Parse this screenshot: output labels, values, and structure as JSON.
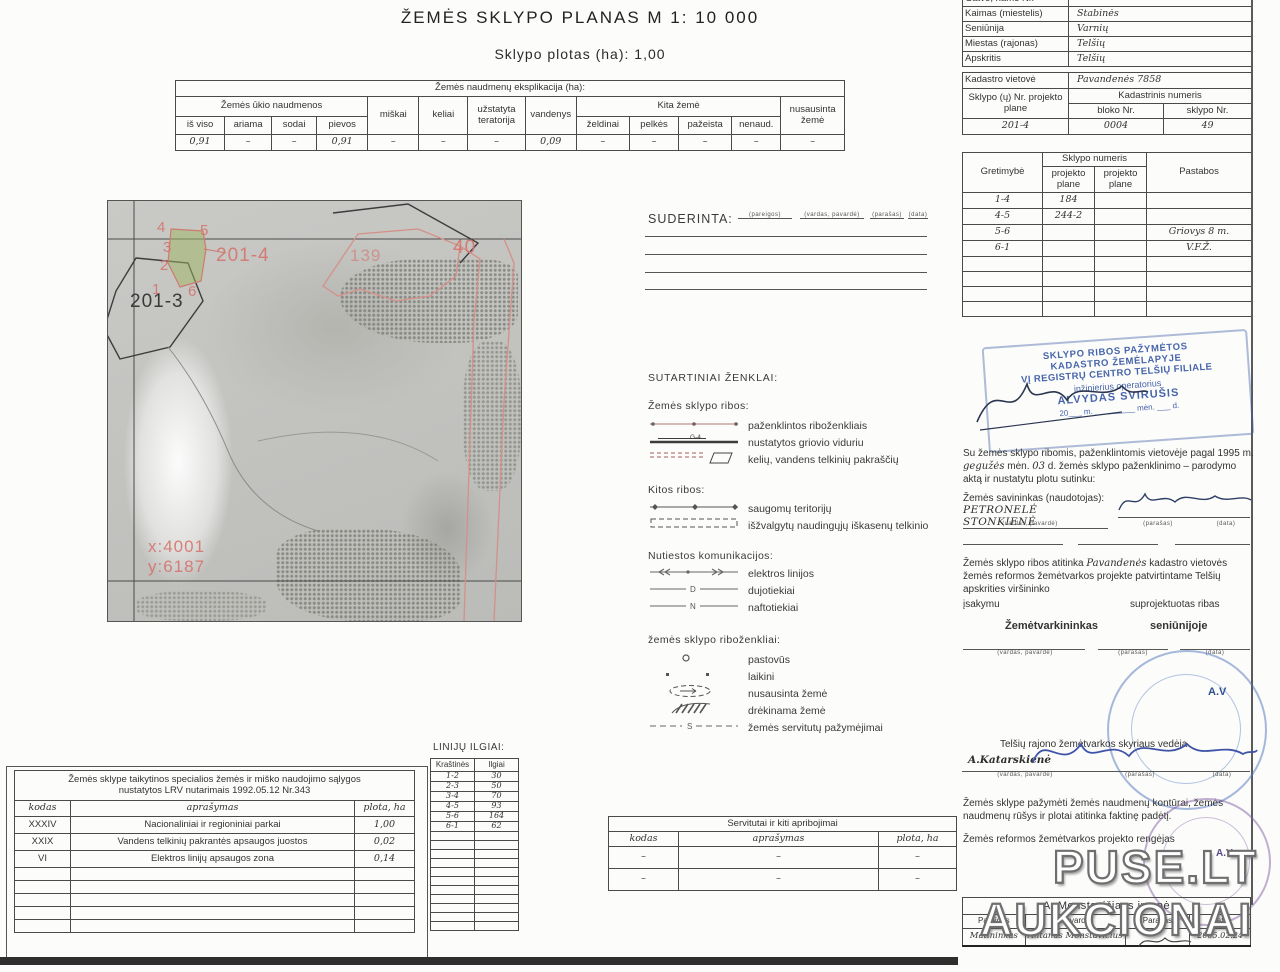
{
  "page": {
    "title": "ŽEMĖS SKLYPO PLANAS M 1: 10 000",
    "subtitle": "Sklypo plotas (ha): 1,00"
  },
  "explication": {
    "title": "Žemės naudmenų eksplikacija (ha):",
    "group_agri": "Žemės ūkio naudmenos",
    "group_kita": "Kita žemė",
    "col_miskai": "miškai",
    "col_keliai": "keliai",
    "col_uzstatyta": "užstatyta teratorija",
    "col_vandenys": "vandenys",
    "col_nusausinta": "nusausinta žemė",
    "sub": [
      "iš viso",
      "ariama",
      "sodai",
      "pievos",
      "želdinai",
      "pelkės",
      "pažeista",
      "nenaud."
    ],
    "values": [
      "0,91",
      "–",
      "–",
      "0,91",
      "–",
      "–",
      "–",
      "0,09",
      "–",
      "–",
      "–",
      "–",
      "–"
    ]
  },
  "location": {
    "rows": [
      {
        "label": "Gatvė, namo Nr.",
        "value": ""
      },
      {
        "label": "Kaimas (miestelis)",
        "value": "Stabinės"
      },
      {
        "label": "Seniūnija",
        "value": "Varnių"
      },
      {
        "label": "Miestas (rajonas)",
        "value": "Telšių"
      },
      {
        "label": "Apskritis",
        "value": "Telšių"
      }
    ]
  },
  "cadastre": {
    "vietove_label": "Kadastro vietovė",
    "vietove_value": "Pavandenės 7858",
    "sklypo_nr_label": "Sklypo (ų) Nr. projekto plane",
    "kadastrinis_label": "Kadastrinis numeris",
    "bloko_label": "bloko Nr.",
    "sklypo_label": "sklypo Nr.",
    "projekto_value": "201-4",
    "bloko_value": "0004",
    "sklypo_value": "49"
  },
  "gretimybe": {
    "h_gretimybe": "Gretimybė",
    "h_sklypo": "Sklypo numeris",
    "h_proj1": "projekto plane",
    "h_proj2": "projekto plane",
    "h_pastabos": "Pastabos",
    "rows": [
      [
        "1-4",
        "184",
        "",
        ""
      ],
      [
        "4-5",
        "244-2",
        "",
        ""
      ],
      [
        "5-6",
        "",
        "",
        "Griovys 8 m."
      ],
      [
        "6-1",
        "",
        "",
        "V.F.Ž."
      ]
    ]
  },
  "stamp": {
    "l1": "SKLYPO RIBOS PAŽYMĖTOS",
    "l2": "KADASTRO ŽEMĖLAPYJE",
    "l3": "VĮ REGISTRŲ CENTRO TELŠIŲ FILIALE",
    "l4": "inžinierius operatorius",
    "l5": "ALVYDAS SVIRUŠIS",
    "date": "20___ m. _________ mėn. ___ d."
  },
  "consent": {
    "p1": "Su žemės sklypo ribomis, paženklintomis vietovėje pagal 1995 m.",
    "month": "gegužės",
    "p2": "mėn.",
    "day": "03",
    "p3": "d. žemės sklypo paženklinimo – parodymo aktą ir nustatytu plotu sutinku:",
    "owner_label": "Žemės savininkas (naudotojas):",
    "owner_name": "PETRONELĖ STONKIENĖ",
    "cap_name": "(vardas, pavardė)",
    "cap_sign": "(parašas)",
    "cap_date": "(data)"
  },
  "match": {
    "a": "Žemės sklypo ribos atitinka",
    "b": "Pavandenės",
    "c": "kadastro vietovės žemės reformos žemėtvarkos projekte patvirtintame Telšių apskrities viršininko",
    "d": "įsakymu",
    "e": "suprojektuotas ribas",
    "role1": "Žemėtvarkininkas",
    "role2": "seniūnijoje"
  },
  "vedeja": {
    "line": "Telšių rajono žemėtvarkos skyriaus vedėja",
    "name": "A.Katarskienė",
    "av": "A.V"
  },
  "note": {
    "text": "Žemės sklype pažymėti žemės naudmenų kontūrai, žemės naudmenų rūšys ir plotai atitinka faktinę padėtį.",
    "text2": "Žemės reformos žemėtvarkos projekto rengėjas"
  },
  "firm": {
    "title": "A. Monstavičiaus įmonė",
    "h": [
      "Pareigos",
      "Pavardė",
      "Parašas",
      "data"
    ],
    "row": [
      "Matininkas",
      "Antanas Monstavičius",
      "",
      "2005.02.24"
    ]
  },
  "watermark": {
    "line1": "PUSE.LT",
    "line2": "AUKCIONAI"
  },
  "suderinta": {
    "label": "SUDERINTA:",
    "caps": [
      "(pareigos)",
      "(vardas, pavardė)",
      "(parašas)",
      "(data)"
    ]
  },
  "legend": {
    "title": "SUTARTINIAI ŽENKLAI:",
    "s1_title": "Žemės sklypo ribos:",
    "s1_items": [
      "paženklintos riboženkliais",
      "nustatytos griovio viduriu",
      "kelių, vandens telkinių pakraščių"
    ],
    "g4": "G-4",
    "s2_title": "Kitos ribos:",
    "s2_items": [
      "saugomų teritorijų",
      "išžvalgytų naudingųjų iškasenų telkinio"
    ],
    "s3_title": "Nutiestos komunikacijos:",
    "s3_items": [
      "elektros linijos",
      "dujotiekiai",
      "naftotiekiai"
    ],
    "sym_d": "D",
    "sym_n": "N",
    "sym_s": "S",
    "s4_title": "žemės sklypo riboženkliai:",
    "s4_items": [
      "pastovūs",
      "laikini",
      "nusausinta žemė",
      "drėkinama žemė",
      "žemės servitutų pažymėjimai"
    ]
  },
  "lengths": {
    "title": "LINIJŲ ILGIAI:",
    "h1": "Kraštinės",
    "h2": "Ilgiai",
    "rows": [
      [
        "1-2",
        "30"
      ],
      [
        "2-3",
        "50"
      ],
      [
        "3-4",
        "70"
      ],
      [
        "4-5",
        "93"
      ],
      [
        "5-6",
        "164"
      ],
      [
        "6-1",
        "62"
      ]
    ]
  },
  "special": {
    "title1": "Žemės sklype taikytinos specialios žemės ir miško naudojimo sąlygos",
    "title2": "nustatytos LRV nutarimais 1992.05.12  Nr.343",
    "h": [
      "kodas",
      "aprašymas",
      "plota, ha"
    ],
    "rows": [
      [
        "XXXIV",
        "Nacionaliniai ir regioniniai parkai",
        "1,00"
      ],
      [
        "XXIX",
        "Vandens telkinių pakrantės apsaugos juostos",
        "0,02"
      ],
      [
        "VI",
        "Elektros linijų apsaugos zona",
        "0,14"
      ]
    ]
  },
  "servitutai": {
    "title": "Servitutai ir kiti apribojimai",
    "h": [
      "kodas",
      "aprašymas",
      "plota, ha"
    ],
    "rows": [
      [
        "–",
        "–",
        "–"
      ],
      [
        "–",
        "–",
        "–"
      ]
    ]
  },
  "map": {
    "plot_main": "201-4",
    "plot_left": "201-3",
    "n139": "139",
    "n40": "40",
    "coord_x": "x:4001",
    "coord_y": "y:6187",
    "v1": "1",
    "v2": "2",
    "v3": "3",
    "v4": "4",
    "v5": "5",
    "v6": "6"
  }
}
